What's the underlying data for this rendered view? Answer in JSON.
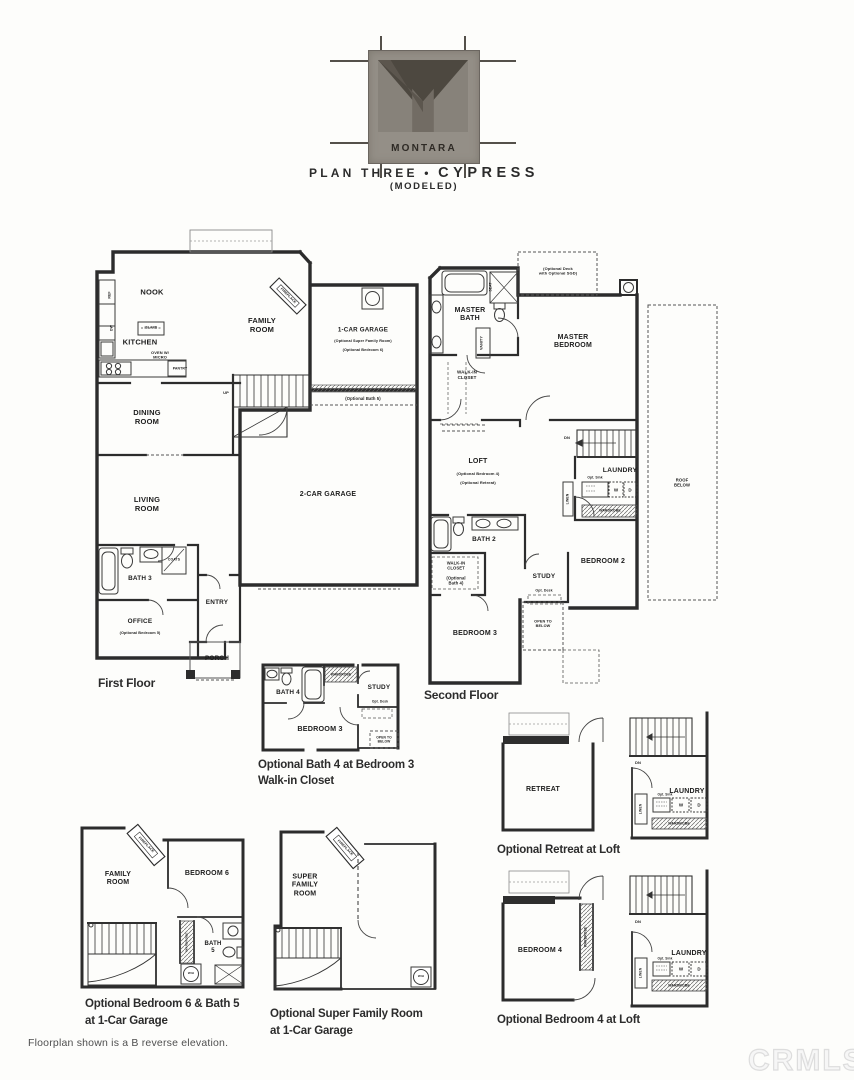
{
  "colors": {
    "ink": "#2c2c2c",
    "caption": "#2c2c2c",
    "watermark": "#ededed",
    "logo_gray": "#948f87"
  },
  "header": {
    "logo_text": "MONTARA",
    "plan_prefix": "PLAN THREE",
    "separator": "•",
    "plan_name": "CYPRESS",
    "modeled": "(MODELED)"
  },
  "first_floor": {
    "caption": "First Floor",
    "nook": "NOOK",
    "kitchen": "KITCHEN",
    "island": "ISLAND",
    "ref": "REF",
    "dw": "DW",
    "oven": "OVEN W/\nMICRO",
    "pantry": "PANTRY",
    "family_room": "FAMILY\nROOM",
    "fireplace": "FIREPLACE",
    "one_car_garage": "1-CAR GARAGE",
    "one_car_note1": "(Optional Super Family Room)",
    "one_car_note2": "(Optional Bedroom 6)",
    "opt_bath5": "(Optional Bath 5)",
    "dining_room": "DINING\nROOM",
    "living_room": "LIVING\nROOM",
    "two_car_garage": "2-CAR GARAGE",
    "bath3": "BATH 3",
    "coats": "COATS",
    "office": "OFFICE",
    "office_note": "(Optional Bedroom 5)",
    "entry": "ENTRY",
    "porch": "PORCH",
    "up": "UP"
  },
  "second_floor": {
    "caption": "Second Floor",
    "master_bath": "MASTER\nBATH",
    "seat": "SEAT",
    "vanity": "VANITY",
    "opt_deck": "(Optional Deck\nwith Optional SGD)",
    "master_bedroom": "MASTER\nBEDROOM",
    "walk_in_closet": "WALK-IN\nCLOSET",
    "loft": "LOFT",
    "loft_note1": "(Optional Bedroom 4)",
    "loft_note2": "(Optional Retreat)",
    "dn": "DN",
    "laundry": "LAUNDRY",
    "opt_sink": "Opt. Sink",
    "washer": "W",
    "dryer": "D",
    "linen": "LINEN",
    "wardrobe": "WARDROBE",
    "bath2": "BATH 2",
    "walk_in_closet2": "WALK-IN\nCLOSET",
    "walk_in_note": "(Optional\nBath 4)",
    "study": "STUDY",
    "opt_desk": "Opt. Desk",
    "bedroom2": "BEDROOM 2",
    "bedroom3": "BEDROOM 3",
    "open_to_below": "OPEN TO\nBELOW",
    "roof_below": "ROOF BELOW"
  },
  "detail_bath4": {
    "caption_line1": "Optional Bath 4 at Bedroom 3",
    "caption_line2": "Walk-in Closet",
    "bath4": "BATH 4",
    "wardrobe": "WARDROBE",
    "study": "STUDY",
    "opt_desk": "Opt. Desk",
    "bedroom3": "BEDROOM 3",
    "open_to_below": "OPEN TO\nBELOW"
  },
  "detail_retreat": {
    "caption": "Optional Retreat at Loft",
    "retreat": "RETREAT",
    "dn": "DN",
    "laundry": "LAUNDRY",
    "opt_sink": "Opt. Sink",
    "washer": "W",
    "dryer": "D",
    "linen": "LINEN",
    "wardrobe": "WARDROBE"
  },
  "detail_bedroom4": {
    "caption": "Optional Bedroom 4 at Loft",
    "bedroom4": "BEDROOM 4",
    "wardrobe_closet": "WARDROBE",
    "dn": "DN",
    "laundry": "LAUNDRY",
    "opt_sink": "Opt. Sink",
    "washer": "W",
    "dryer": "D",
    "linen": "LINEN",
    "wardrobe": "WARDROBE"
  },
  "detail_bed6_bath5": {
    "caption_line1": "Optional Bedroom 6 & Bath 5",
    "caption_line2": "at 1-Car Garage",
    "family_room": "FAMILY\nROOM",
    "fireplace": "FIREPLACE",
    "bedroom6": "BEDROOM 6",
    "wardrobe": "WARDROBE",
    "bath5": "BATH\n5",
    "water_heater": "W/H"
  },
  "detail_super_family": {
    "caption_line1": "Optional Super Family Room",
    "caption_line2": "at 1-Car Garage",
    "super_family_room": "SUPER\nFAMILY\nROOM",
    "fireplace": "FIREPLACE",
    "water_heater": "W/H"
  },
  "footer": {
    "note": "Floorplan shown is a B reverse elevation.",
    "watermark": "CRMLS"
  }
}
